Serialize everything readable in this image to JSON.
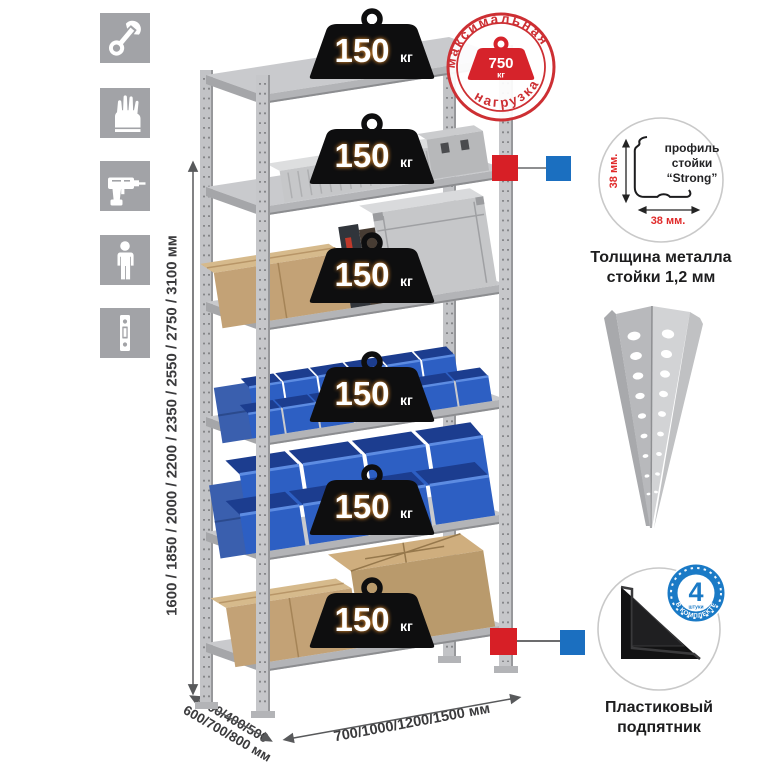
{
  "icons": [
    {
      "name": "wrench-icon"
    },
    {
      "name": "gloves-icon"
    },
    {
      "name": "drill-icon"
    },
    {
      "name": "person-icon"
    },
    {
      "name": "rack-post-icon"
    }
  ],
  "dims": {
    "height": "1600 / 1850 / 2000 / 2200 / 2350 / 2550 / 2750 / 3100 мм",
    "depth1": "300/400/500",
    "depth2": "600/700/800 мм",
    "width": "700/1000/1200/1500 мм"
  },
  "rack": {
    "shelves": [
      {
        "load": "150",
        "unit": "кг"
      },
      {
        "load": "150",
        "unit": "кг"
      },
      {
        "load": "150",
        "unit": "кг"
      },
      {
        "load": "150",
        "unit": "кг"
      },
      {
        "load": "150",
        "unit": "кг"
      },
      {
        "load": "150",
        "unit": "кг"
      }
    ]
  },
  "stamp": {
    "arc_top": "максимальная",
    "arc_bottom": "нагрузка",
    "value": "750",
    "unit": "кг"
  },
  "profile": {
    "dim_v": "38 мм.",
    "dim_h": "38 мм.",
    "label1": "профиль",
    "label2": "стойки",
    "label3": "“Strong”",
    "caption": "Толщина металла стойки 1,2 мм"
  },
  "foot": {
    "badge_value": "4",
    "badge_small": "штуки",
    "badge_text": "В КОМПЛЕКТЕ",
    "caption": "Пластиковый подпятник"
  },
  "colors": {
    "stamp_red": "#cd2f33",
    "marker_red": "#d71f26",
    "marker_blue": "#1b6fc0",
    "bin_blue": "#2d5fc3",
    "badge_blue": "#1a7ac6",
    "metal_gray": "#c9cacd",
    "icon_gray": "#a2a3a7",
    "weight_black": "#0e0e0f"
  }
}
